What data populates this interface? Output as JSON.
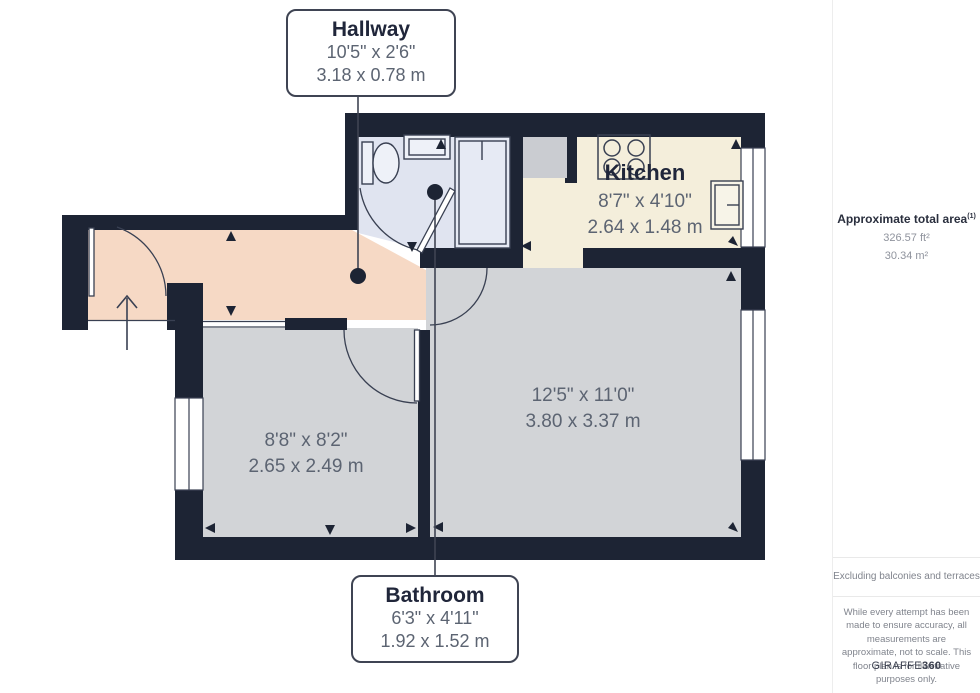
{
  "callouts": {
    "hallway": {
      "title": "Hallway",
      "imperial": "10'5\" x 2'6\"",
      "metric": "3.18 x 0.78 m"
    },
    "bathroom": {
      "title": "Bathroom",
      "imperial": "6'3\" x 4'11\"",
      "metric": "1.92 x 1.52 m"
    }
  },
  "rooms": {
    "kitchen": {
      "title": "Kitchen",
      "imperial": "8'7\" x 4'10\"",
      "metric": "2.64 x 1.48 m"
    },
    "living": {
      "imperial": "12'5\" x 11'0\"",
      "metric": "3.80 x 3.37 m"
    },
    "bedroom": {
      "imperial": "8'8\" x 8'2\"",
      "metric": "2.65 x 2.49 m"
    }
  },
  "sidebar": {
    "area_title": "Approximate total area",
    "area_sup": "(1)",
    "area_ft": "326.57 ft²",
    "area_m": "30.34 m²",
    "excluding": "Excluding balconies and terraces",
    "disclaimer": "While every attempt has been made to ensure accuracy, all measurements are approximate, not to scale. This floor plan is for illustrative purposes only.",
    "brand": "GIRAFFE",
    "brand_bold": "360"
  },
  "colors": {
    "wall": "#1d2434",
    "floor-hall": "#f6d9c5",
    "floor-kitchen": "#f4eedb",
    "floor-room": "#d2d4d7",
    "floor-bath": "#e0e4f0",
    "fixture": "#394052",
    "line": "#3f4453",
    "ink": "#20263a",
    "dim": "#5c6472"
  }
}
